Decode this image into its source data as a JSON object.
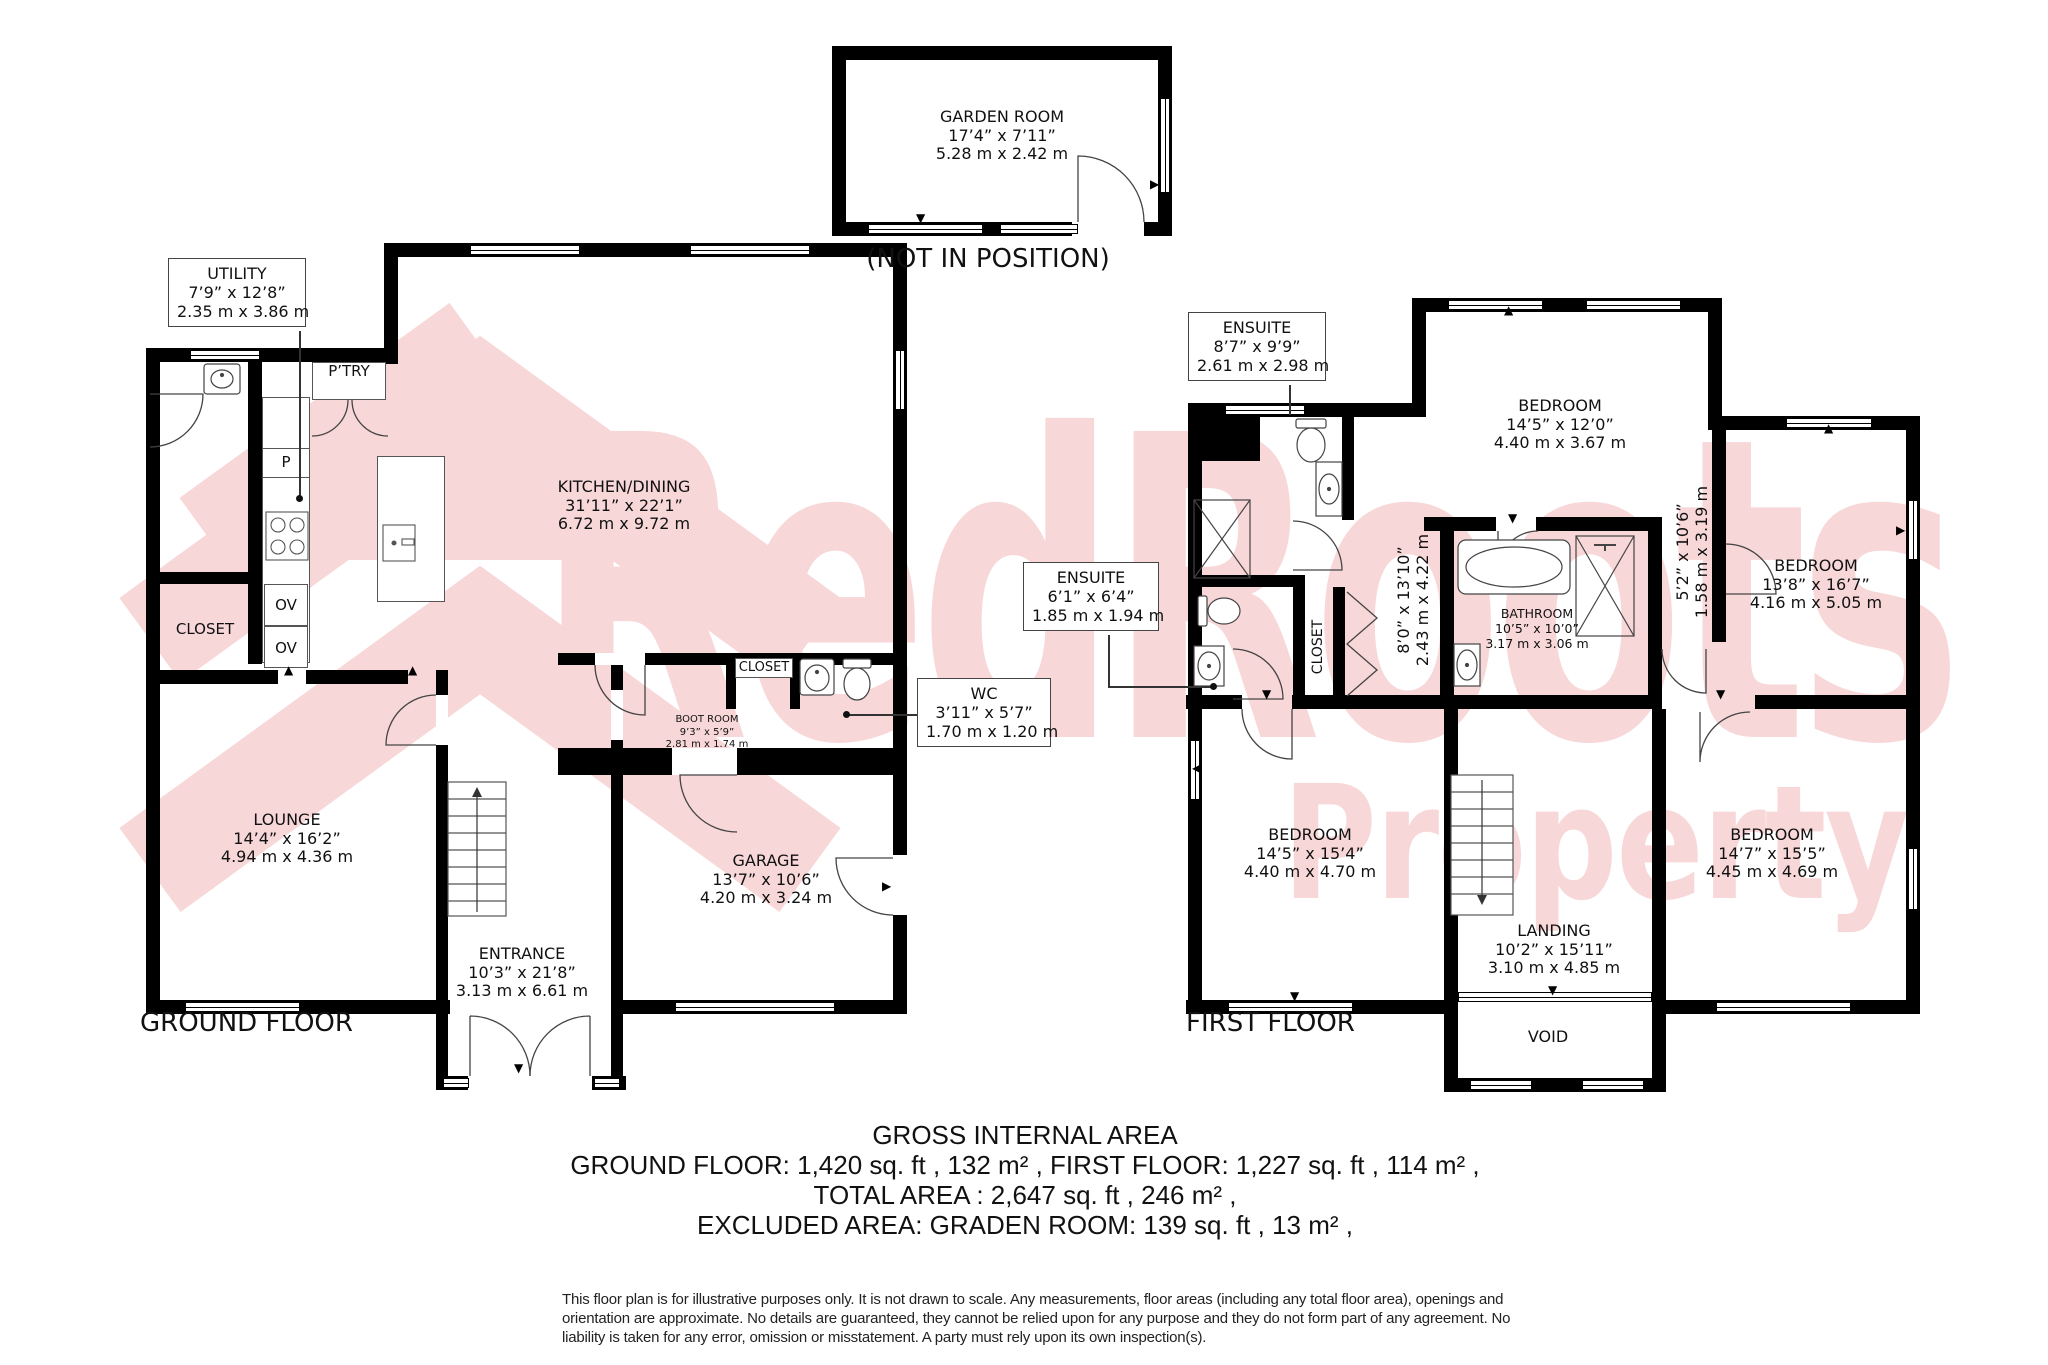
{
  "icons": {
    "up": "▲",
    "down": "▼",
    "left": "◀",
    "right": "▶"
  },
  "watermark": {
    "line1": "RedRoots",
    "line2": "Property",
    "color": "#f8d7d8"
  },
  "garden_room": {
    "name": "GARDEN ROOM",
    "imperial": "17’4” x 7’11”",
    "metric": "5.28 m x 2.42 m",
    "note": "(NOT IN POSITION)"
  },
  "ground_floor": {
    "label": "GROUND FLOOR",
    "utility": {
      "name": "UTILITY",
      "imperial": "7’9” x 12’8”",
      "metric": "2.35 m x 3.86 m"
    },
    "pantry": "P’TRY",
    "p": "P",
    "ov": "OV",
    "closet": "CLOSET",
    "kitchen": {
      "name": "KITCHEN/DINING",
      "imperial": "31’11” x 22’1”",
      "metric": "6.72 m x 9.72 m"
    },
    "lounge": {
      "name": "LOUNGE",
      "imperial": "14’4” x 16’2”",
      "metric": "4.94 m x 4.36 m"
    },
    "closet2": "CLOSET",
    "boot_room": {
      "name": "BOOT ROOM",
      "imperial": "9’3” x 5’9”",
      "metric": "2.81 m x 1.74 m"
    },
    "wc": {
      "name": "WC",
      "imperial": "3’11” x 5’7”",
      "metric": "1.70 m x 1.20 m"
    },
    "garage": {
      "name": "GARAGE",
      "imperial": "13’7” x 10’6”",
      "metric": "4.20 m x 3.24 m"
    },
    "entrance": {
      "name": "ENTRANCE",
      "imperial": "10’3” x 21’8”",
      "metric": "3.13 m x 6.61 m"
    }
  },
  "first_floor": {
    "label": "FIRST FLOOR",
    "ensuite_top": {
      "name": "ENSUITE",
      "imperial": "8’7” x 9’9”",
      "metric": "2.61 m x 2.98 m"
    },
    "bedroom_top": {
      "name": "BEDROOM",
      "imperial": "14’5” x 12’0”",
      "metric": "4.40 m x 3.67 m"
    },
    "hall": {
      "imperial": "8’0” x 13’10”",
      "metric": "2.43 m x 4.22 m"
    },
    "bathroom": {
      "name": "BATHROOM",
      "imperial": "10’5” x 10’0”",
      "metric": "3.17 m x 3.06 m"
    },
    "nook": {
      "imperial": "5’2” x 10’6”",
      "metric": "1.58 m x 3.19 m"
    },
    "bedroom_right": {
      "name": "BEDROOM",
      "imperial": "13’8” x 16’7”",
      "metric": "4.16 m x 5.05 m"
    },
    "ensuite_mid": {
      "name": "ENSUITE",
      "imperial": "6’1” x 6’4”",
      "metric": "1.85 m x 1.94 m"
    },
    "closet": "CLOSET",
    "bedroom_bottom_left": {
      "name": "BEDROOM",
      "imperial": "14’5” x 15’4”",
      "metric": "4.40 m x 4.70 m"
    },
    "landing": {
      "name": "LANDING",
      "imperial": "10’2” x 15’11”",
      "metric": "3.10 m x 4.85 m"
    },
    "void": "VOID",
    "bedroom_bottom_right": {
      "name": "BEDROOM",
      "imperial": "14’7” x 15’5”",
      "metric": "4.45 m x 4.69 m"
    }
  },
  "summary": {
    "title": "GROSS INTERNAL AREA",
    "line1": "GROUND FLOOR: 1,420 sq. ft , 132 m² , FIRST FLOOR: 1,227 sq. ft , 114 m² ,",
    "line2": "TOTAL AREA : 2,647 sq. ft , 246 m² ,",
    "line3": "EXCLUDED AREA: GRADEN ROOM: 139 sq. ft , 13 m² ,"
  },
  "disclaimer": "This floor plan is for illustrative purposes only. It is not drawn to scale. Any measurements, floor areas (including any total floor area), openings and orientation are approximate. No details are guaranteed, they cannot be relied upon for any purpose and they do not form part of any agreement. No liability is taken for any error, omission or misstatement. A party must rely upon its own inspection(s)."
}
